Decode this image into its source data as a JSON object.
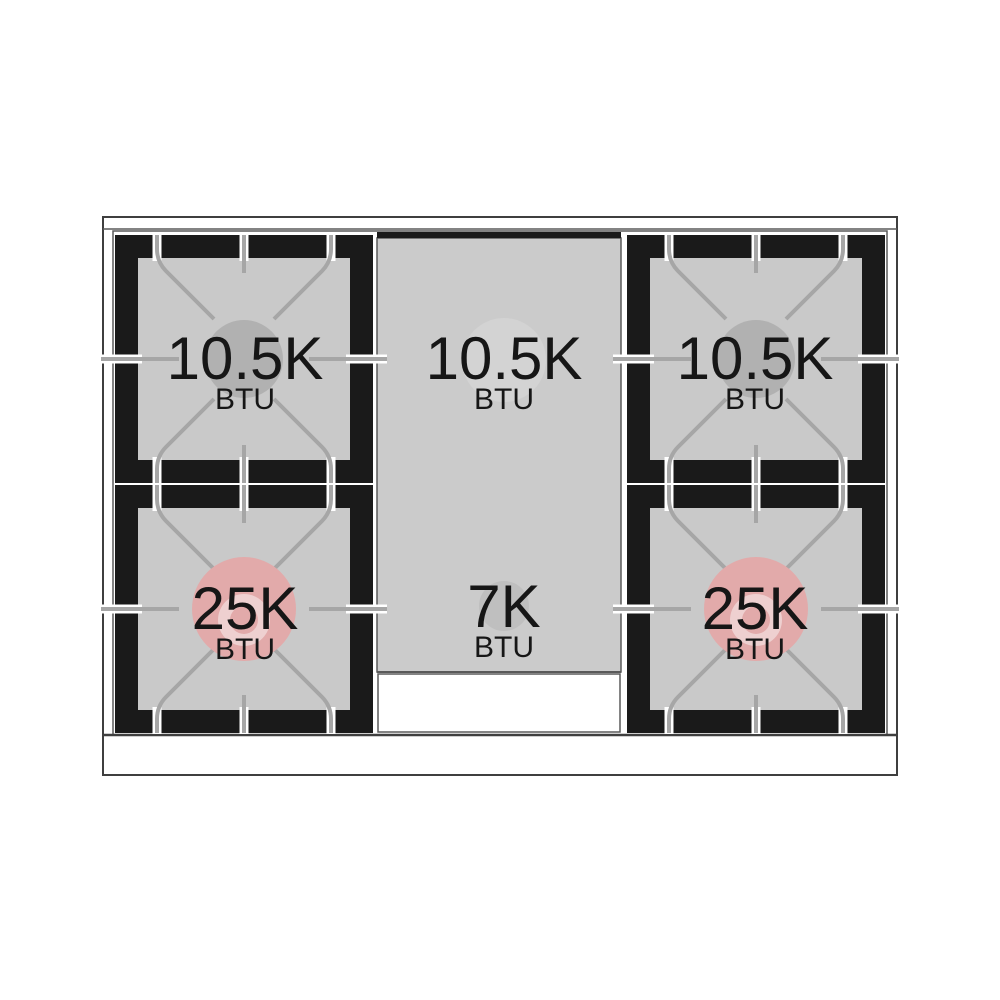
{
  "diagram": {
    "kind": "gas-range-cooktop-burner-layout",
    "burners": [
      {
        "id": "top-left",
        "btu": "10.5K",
        "unit": "BTU"
      },
      {
        "id": "top-center",
        "btu": "10.5K",
        "unit": "BTU"
      },
      {
        "id": "top-right",
        "btu": "10.5K",
        "unit": "BTU"
      },
      {
        "id": "bottom-left",
        "btu": "25K",
        "unit": "BTU"
      },
      {
        "id": "bottom-center",
        "btu": "7K",
        "unit": "BTU"
      },
      {
        "id": "bottom-right",
        "btu": "25K",
        "unit": "BTU"
      }
    ],
    "colors": {
      "frame_black": "#1a1a1a",
      "surface_gray": "#c9c9c9",
      "panel_gray": "#cbcbcb",
      "grate_gray": "#a6a6a6",
      "burner_gray": "#b1b1b1",
      "center_burner_gray": "#d3d3d3",
      "small_burner_gray": "#bfbfbf",
      "burner_pink": "#e2aaaa",
      "burner_ring_pink": "#eed0d0",
      "label_color": "#161616",
      "outline": "#3f3f3f",
      "line": "#5a5a5a"
    }
  }
}
